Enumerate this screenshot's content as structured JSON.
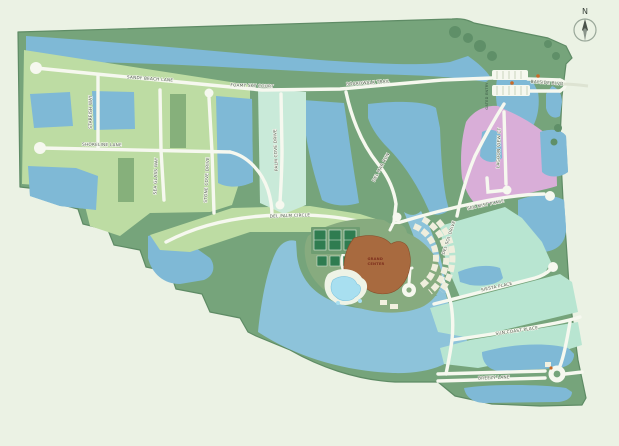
{
  "palette": {
    "background": "#ebf2e4",
    "greenway": "#76a47b",
    "greenway_dark": "#5e8b65",
    "water": "#7fb9d6",
    "bay_water": "#8dc3da",
    "lot_green": "#bddca3",
    "lot_teal": "#c9ead9",
    "lot_mint": "#b8e5d1",
    "lot_pink": "#d9aed8",
    "road": "#f6f8ef",
    "clubhouse_brown": "#a86a3f",
    "tennis_green": "#2f7c50",
    "pool_blue": "#a8dff0",
    "guard_orange": "#c96a2a"
  },
  "compass": {
    "label": "N"
  },
  "entry": {
    "gated_label": "GATED ENTRY"
  },
  "resort": {
    "clubhouse_line1": "GRAND",
    "clubhouse_line2": "CENTER"
  },
  "streets": [
    {
      "name": "sandy-beach-lane",
      "label": "SANDY BEACH LANE",
      "x": 150,
      "y": 80,
      "rot": 4
    },
    {
      "name": "foamy-sky-court",
      "label": "FOAMY SKY COURT",
      "x": 252,
      "y": 87,
      "rot": 2
    },
    {
      "name": "boardwalk-trail",
      "label": "BOARDWALK TRAIL",
      "x": 368,
      "y": 84,
      "rot": -4
    },
    {
      "name": "starfish-way",
      "label": "STARFISH WAY",
      "x": 92,
      "y": 112,
      "rot": -90
    },
    {
      "name": "shoreline-lane",
      "label": "SHORELINE LANE",
      "x": 102,
      "y": 146,
      "rot": 1
    },
    {
      "name": "sea-glass-way",
      "label": "SEA GLASS WAY",
      "x": 157,
      "y": 176,
      "rot": -88
    },
    {
      "name": "stone-cove-drive",
      "label": "STONE COVE DRIVE",
      "x": 208,
      "y": 180,
      "rot": -87
    },
    {
      "name": "palm-cove-drive",
      "label": "PALM COVE DRIVE",
      "x": 277,
      "y": 150,
      "rot": -92
    },
    {
      "name": "del-palm-circle",
      "label": "DEL PALM CIRCLE",
      "x": 290,
      "y": 217,
      "rot": -2
    },
    {
      "name": "del-mar-run",
      "label": "DEL MAR RUN",
      "x": 382,
      "y": 168,
      "rot": -62
    },
    {
      "name": "sea-mist-place",
      "label": "SEA MIST PLACE",
      "x": 486,
      "y": 206,
      "rot": -12
    },
    {
      "name": "lagoon-view-court",
      "label": "LAGOON VIEW CT",
      "x": 500,
      "y": 148,
      "rot": -88
    },
    {
      "name": "del-sol-drive",
      "label": "DEL SOL DRIVE",
      "x": 450,
      "y": 238,
      "rot": -72
    },
    {
      "name": "siesta-place",
      "label": "SIESTA PLACE",
      "x": 497,
      "y": 288,
      "rot": -12
    },
    {
      "name": "sun-coast-place",
      "label": "SUN COAST PLACE",
      "x": 517,
      "y": 332,
      "rot": -8
    },
    {
      "name": "breezy-lane",
      "label": "BREEZY LANE",
      "x": 494,
      "y": 379,
      "rot": -2
    },
    {
      "name": "bayside-blvd",
      "label": "BAYSIDE BLVD",
      "x": 547,
      "y": 84,
      "rot": 4
    }
  ]
}
